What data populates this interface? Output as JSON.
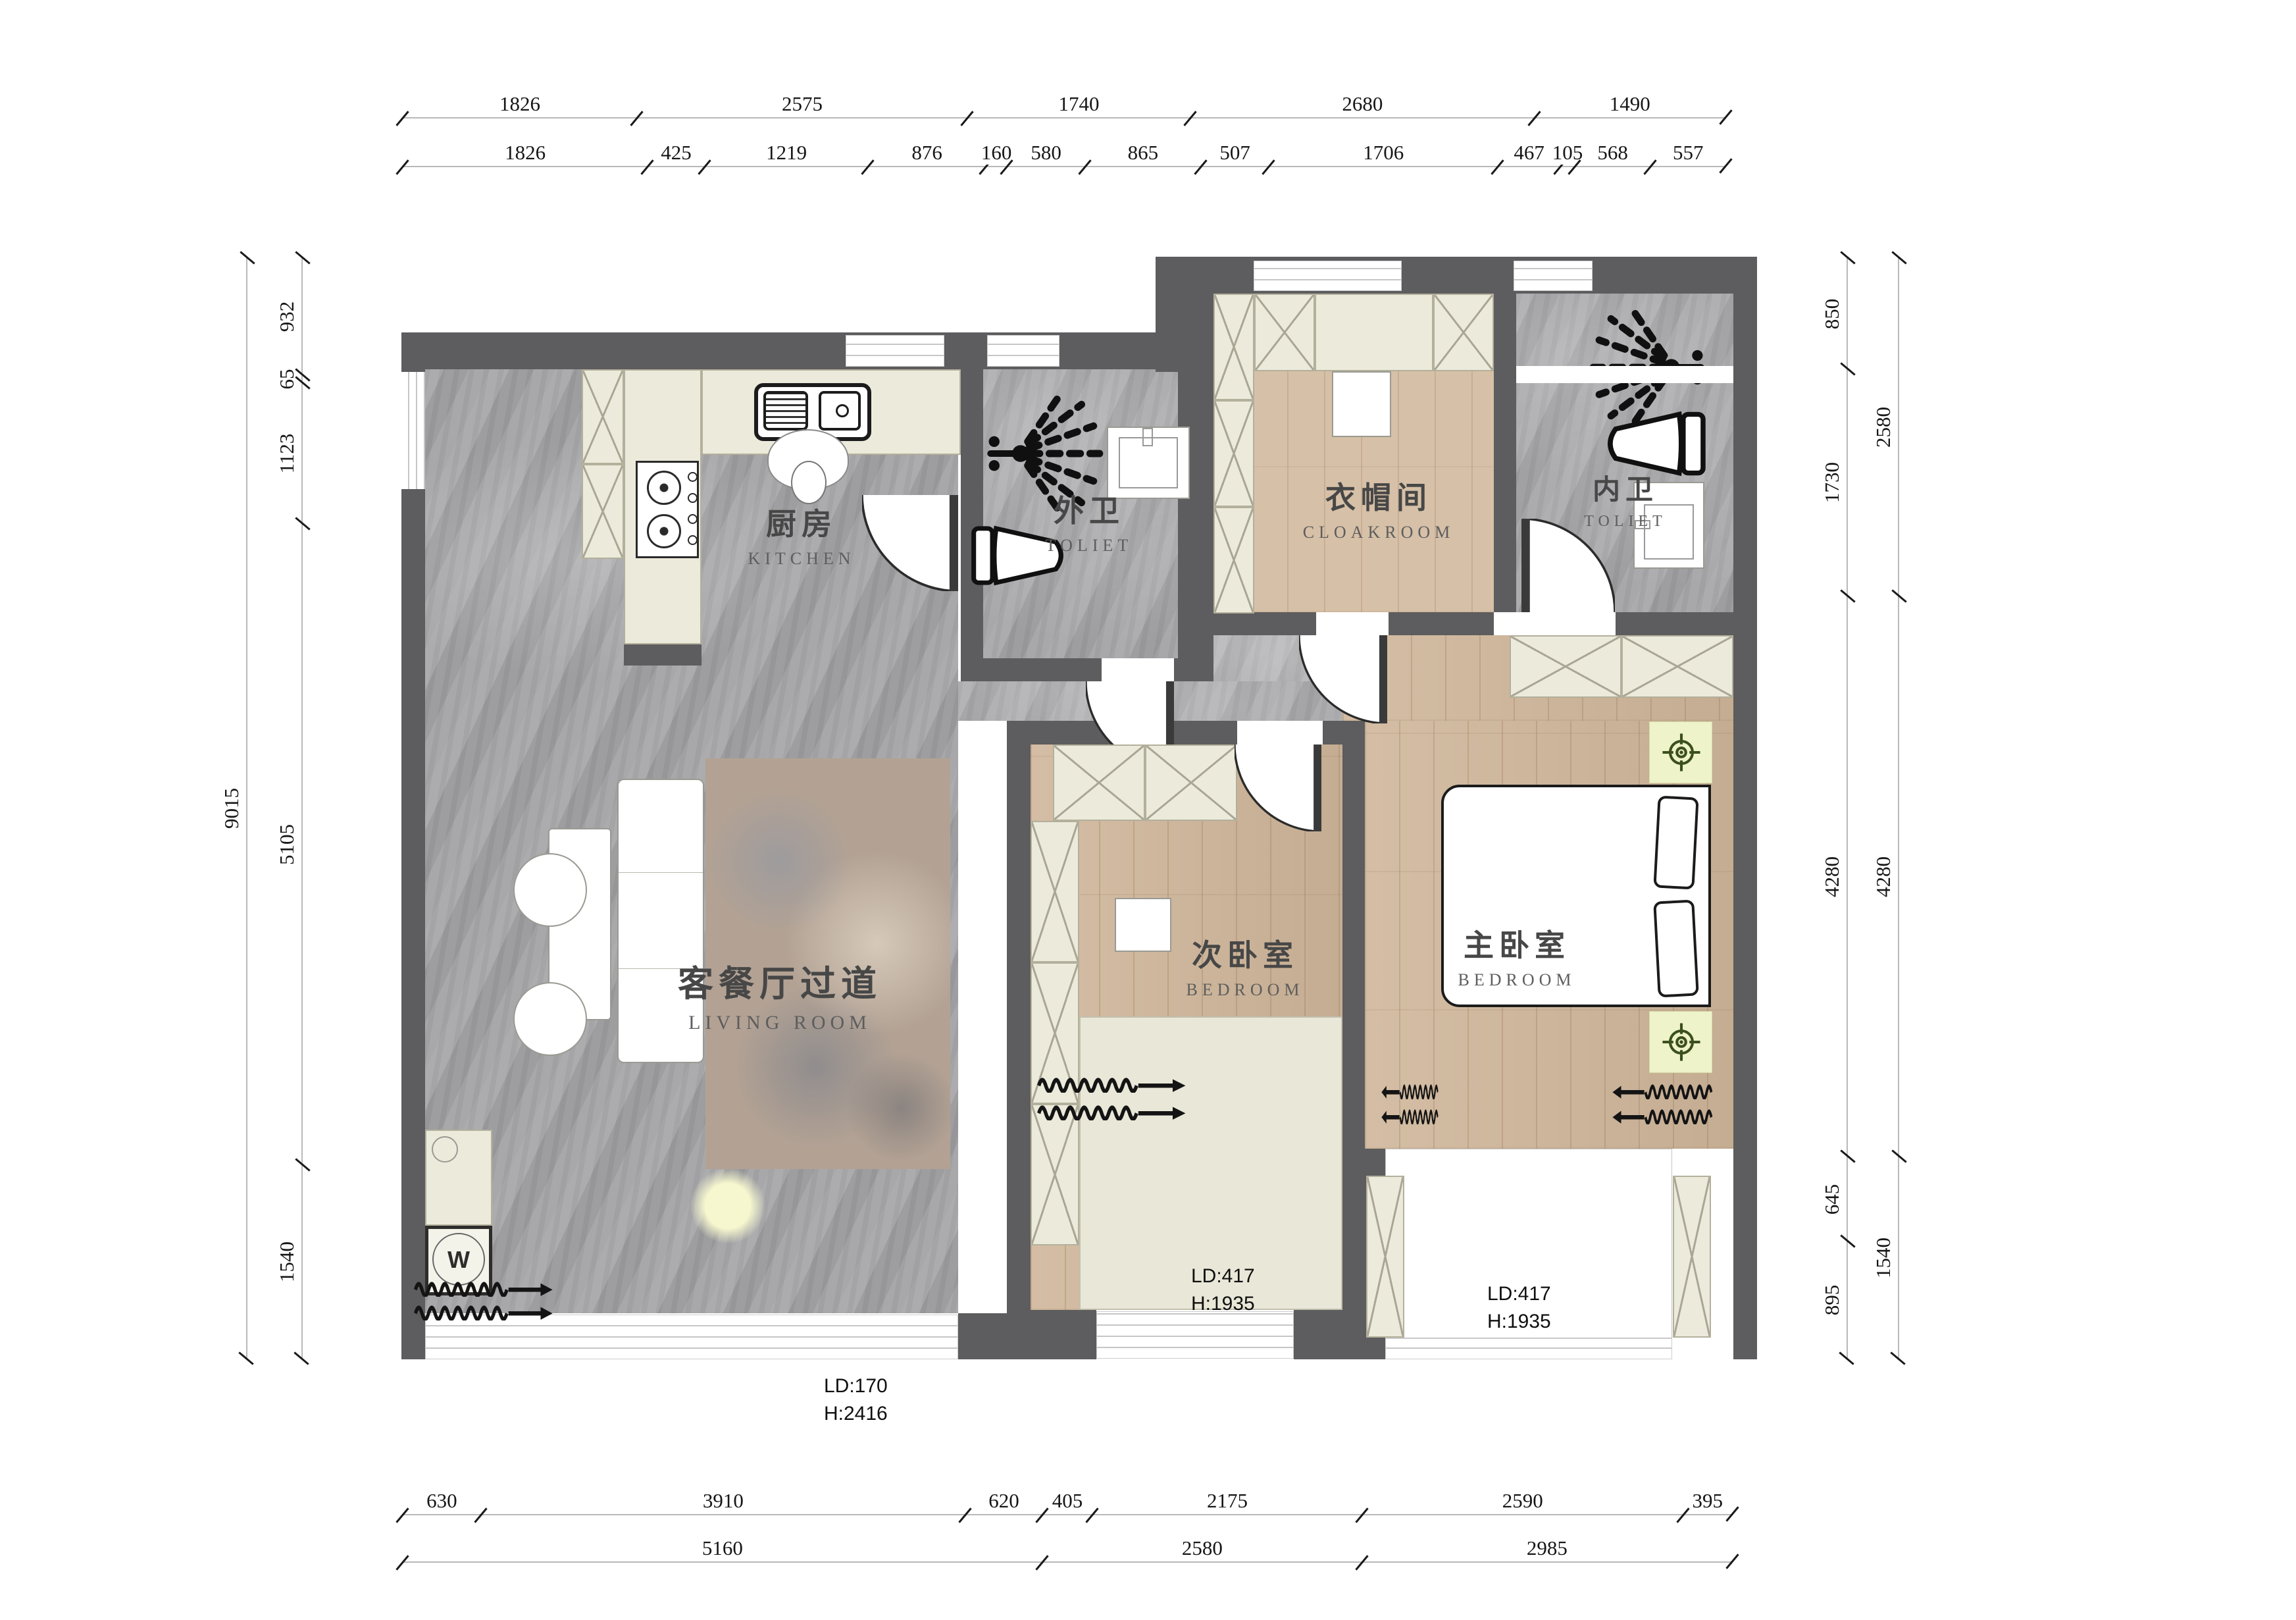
{
  "palette": {
    "wall": "#5d5c5e",
    "stone_floor": "#a2a2a4",
    "wood_floor": "#cfb69a",
    "cream_cabinet": "#eceadb",
    "fixture_outline": "#222222",
    "accent_pad": "#eef3c9",
    "accent_icon": "#3c4f1e"
  },
  "rooms": {
    "kitchen": {
      "zh": "厨房",
      "en": "KITCHEN"
    },
    "outer_toilet": {
      "zh": "外卫",
      "en": "TOLIET"
    },
    "cloakroom": {
      "zh": "衣帽间",
      "en": "CLOAKROOM"
    },
    "inner_toilet": {
      "zh": "内卫",
      "en": "TOLIET"
    },
    "living": {
      "zh": "客餐厅过道",
      "en": "LIVING  ROOM"
    },
    "second_bedroom": {
      "zh": "次卧室",
      "en": "BEDROOM"
    },
    "master_bedroom": {
      "zh": "主卧室",
      "en": "BEDROOM"
    }
  },
  "annotations": {
    "living_window": {
      "line1": "LD:170",
      "line2": "H:2416"
    },
    "second_bay": {
      "line1": "LD:417",
      "line2": "H:1935"
    },
    "master_bay": {
      "line1": "LD:417",
      "line2": "H:1935"
    },
    "washer_label": "W"
  },
  "dimensions": {
    "top_row1": [
      1826,
      2575,
      1740,
      2680,
      1490
    ],
    "top_row2": [
      1826,
      425,
      1219,
      876,
      160,
      580,
      865,
      507,
      1706,
      467,
      105,
      568,
      557
    ],
    "bottom_row1": [
      630,
      3910,
      620,
      405,
      2175,
      2590,
      395
    ],
    "bottom_row2": [
      5160,
      2580,
      2985
    ],
    "left_outer": [
      9015
    ],
    "left_inner": [
      932,
      65,
      1123,
      5105,
      1540
    ],
    "right_inner": [
      850,
      1730,
      4280,
      645,
      895
    ],
    "right_outer": [
      2580,
      4280,
      1540
    ]
  }
}
